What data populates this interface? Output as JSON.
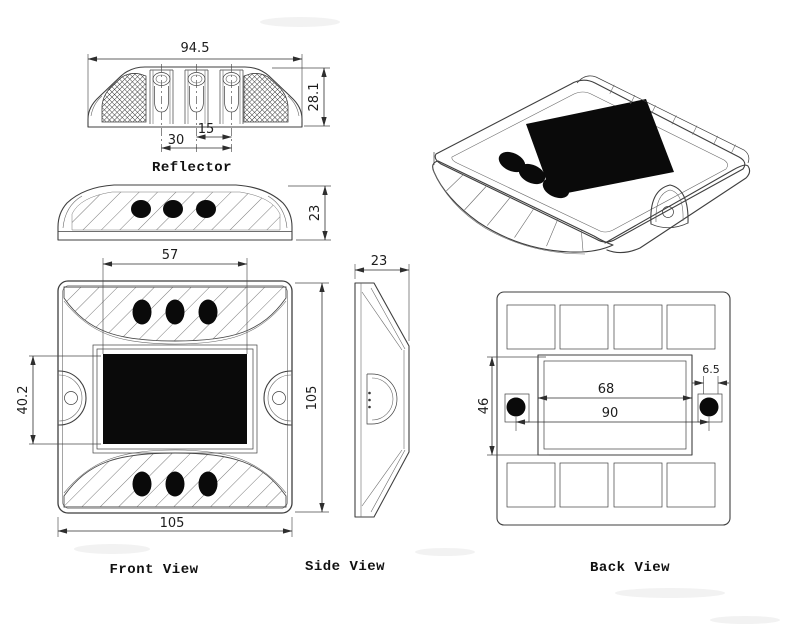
{
  "drawing": {
    "background": "#ffffff",
    "line_color": "#3f3f3f",
    "views": {
      "reflector": {
        "label": "Reflector",
        "dims": {
          "width": "94.5",
          "height": "28.1",
          "pitch_outer": "30",
          "pitch_inner": "15"
        }
      },
      "dome": {
        "dims": {
          "height": "23"
        }
      },
      "front": {
        "label": "Front View",
        "dims": {
          "panel_width": "57",
          "panel_height": "40.2",
          "overall_height": "105",
          "overall_width": "105"
        }
      },
      "side": {
        "label": "Side View",
        "dims": {
          "thickness": "23"
        }
      },
      "back": {
        "label": "Back View",
        "dims": {
          "inner_width": "68",
          "hole_span": "90",
          "hole_width": "6.5",
          "inner_height": "46"
        }
      }
    }
  }
}
